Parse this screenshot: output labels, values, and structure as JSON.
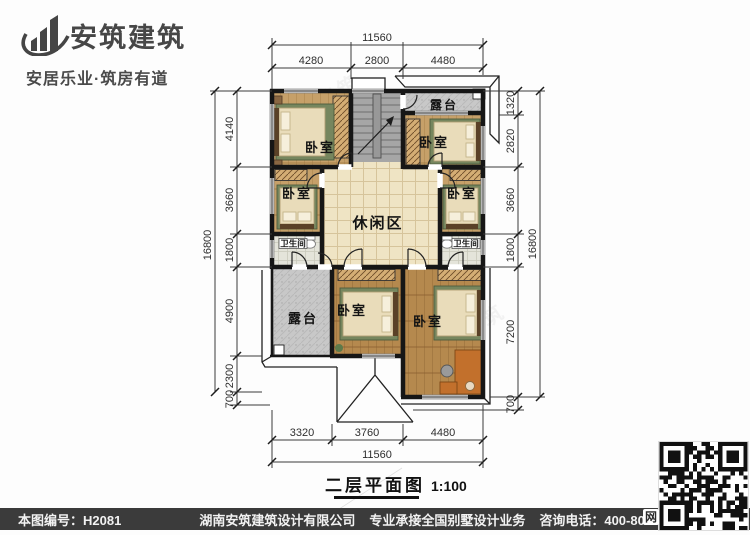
{
  "logo": {
    "name": "安筑建筑",
    "tagline": "安居乐业·筑房有道"
  },
  "plan": {
    "title": "二层平面图",
    "scale": "1:100",
    "rooms": {
      "bedroom_top_left": "卧室",
      "bedroom_top_right": "卧室",
      "bedroom_mid_left": "卧室",
      "bedroom_mid_right": "卧室",
      "bedroom_bottom_center": "卧室",
      "bedroom_bottom_right": "卧室",
      "leisure_area": "休闲区",
      "terrace_top": "露台",
      "terrace_bottom": "露台",
      "bath_left": "卫生间",
      "bath_right": "卫生间"
    },
    "dims": {
      "top": {
        "total": "11560",
        "segments": [
          "4280",
          "2800",
          "4480"
        ]
      },
      "bottom": {
        "total": "11560",
        "segments": [
          "3320",
          "3760",
          "4480"
        ]
      },
      "left": {
        "total": "16800",
        "segments": [
          "4140",
          "3660",
          "1800",
          "4900",
          "2300",
          "700"
        ]
      },
      "right": {
        "total": "16800",
        "segments": [
          "1320",
          "2820",
          "3660",
          "1800",
          "7200",
          "700"
        ]
      }
    },
    "watermark": "安筑建筑"
  },
  "footer": {
    "drawing_no": "本图编号：H2081",
    "company": "湖南安筑建筑设计有限公司",
    "service": "专业承接全国别墅设计业务",
    "phone": "咨询电话：400-8070-511",
    "qr_label": "网"
  },
  "colors": {
    "bar": "#3b3b3b",
    "wall": "#161616",
    "wood_light": "#c6a069",
    "wood_dark": "#b5894e",
    "tile": "#efe4c4",
    "terrace": "#c8c8c8",
    "rug_green": "#76865e",
    "desk_orange": "#c2702c"
  }
}
